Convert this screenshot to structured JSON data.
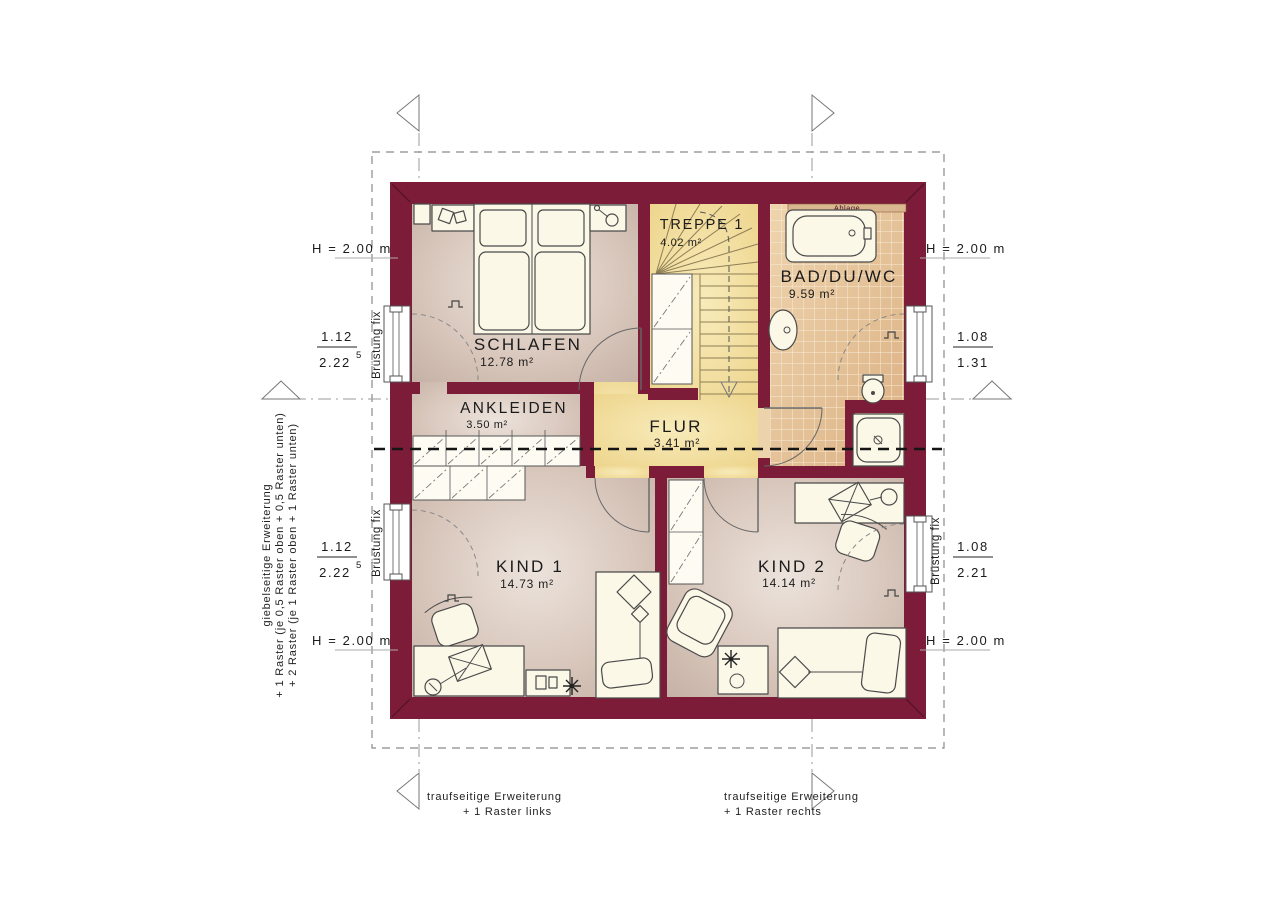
{
  "colors": {
    "wall": "#7c1c39",
    "wall_dark": "#581226",
    "floor": "#cdb9ae",
    "floor_light": "#eae1da",
    "flur": "#f1dd9c",
    "stair": "#f3e3a6",
    "tile": "#e6c79e",
    "grout": "#f6ead2",
    "furniture": "#fcf8e8"
  },
  "rooms": {
    "schlafen": {
      "name": "SCHLAFEN",
      "area": "12.78 m²"
    },
    "ankleiden": {
      "name": "ANKLEIDEN",
      "area": "3.50 m²"
    },
    "treppe": {
      "name": "TREPPE 1",
      "area": "4.02 m²"
    },
    "bad": {
      "name": "BAD/DU/WC",
      "area": "9.59 m²"
    },
    "flur": {
      "name": "FLUR",
      "area": "3.41 m²"
    },
    "kind1": {
      "name": "KIND 1",
      "area": "14.73 m²"
    },
    "kind2": {
      "name": "KIND 2",
      "area": "14.14 m²"
    }
  },
  "heights": {
    "left_top": "H = 2.00 m",
    "right_top": "H = 2.00 m",
    "left_bottom": "H = 2.00 m",
    "right_bottom": "H = 2.00 m"
  },
  "dimensions": {
    "left_top": {
      "num": "1.12",
      "den": "2.22",
      "sup": "5"
    },
    "left_bottom": {
      "num": "1.12",
      "den": "2.22",
      "sup": "5"
    },
    "right_top": {
      "num": "1.08",
      "den": "1.31",
      "sup": ""
    },
    "right_bottom": {
      "num": "1.08",
      "den": "2.21",
      "sup": ""
    }
  },
  "labels": {
    "brustung_fix": "Brüstung fix",
    "ablage": "Ablage"
  },
  "notes": {
    "gable": {
      "line1": "giebelseitige Erweiterung",
      "line2": "+ 1 Raster (je 0,5 Raster oben + 0,5 Raster unten)",
      "line3": "+ 2 Raster (je 1 Raster oben + 1 Raster unten)"
    },
    "eave_left": {
      "line1": "traufseitige Erweiterung",
      "line2": "+ 1 Raster links"
    },
    "eave_right": {
      "line1": "traufseitige Erweiterung",
      "line2": "+ 1 Raster rechts"
    }
  }
}
